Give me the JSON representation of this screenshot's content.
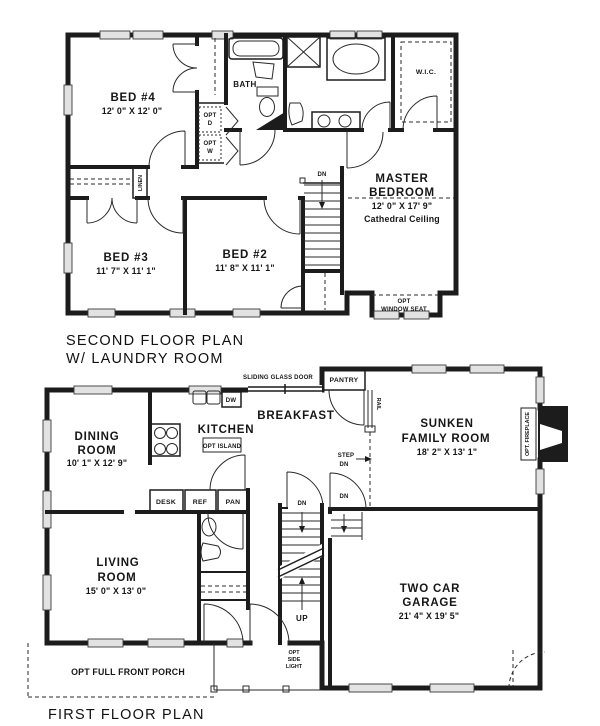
{
  "page": {
    "background": "#ffffff",
    "ink": "#1c1c1c"
  },
  "second_floor": {
    "plan_title_line1": "SECOND FLOOR PLAN",
    "plan_title_line2": "W/ LAUNDRY ROOM",
    "rooms": {
      "bed4": {
        "name": "BED #4",
        "dims": "12' 0\" X 12' 0\""
      },
      "bath": {
        "name": "BATH"
      },
      "wic": {
        "name": "W.I.C."
      },
      "master_bedroom": {
        "name_line1": "MASTER",
        "name_line2": "BEDROOM",
        "dims": "12' 0\" X 17' 9\"",
        "ceiling_note": "Cathedral Ceiling"
      },
      "bed3": {
        "name": "BED #3",
        "dims": "11' 7\" X 11' 1\""
      },
      "bed2": {
        "name": "BED #2",
        "dims": "11' 8\" X 11' 1\""
      }
    },
    "labels": {
      "linen": "LINEN",
      "opt_dryer_line1": "OPT",
      "opt_dryer_line2": "D",
      "opt_washer_line1": "OPT",
      "opt_washer_line2": "W",
      "stairs_down": "DN",
      "window_seat_line1": "OPT",
      "window_seat_line2": "WINDOW SEAT"
    }
  },
  "first_floor": {
    "plan_title": "FIRST FLOOR PLAN",
    "rooms": {
      "dining": {
        "name_line1": "DINING",
        "name_line2": "ROOM",
        "dims": "10' 1\" X 12' 9\""
      },
      "kitchen": {
        "name": "KITCHEN",
        "island": "OPT ISLAND"
      },
      "breakfast": {
        "name": "BREAKFAST"
      },
      "family": {
        "name_line1": "SUNKEN",
        "name_line2": "FAMILY ROOM",
        "dims": "18' 2\" X 13' 1\""
      },
      "living": {
        "name_line1": "LIVING",
        "name_line2": "ROOM",
        "dims": "15' 0\" X 13' 0\""
      },
      "garage": {
        "name_line1": "TWO CAR",
        "name_line2": "GARAGE",
        "dims": "21' 4\" X 19' 5\""
      }
    },
    "labels": {
      "sliding_glass_door": "SLIDING GLASS DOOR",
      "pantry": "PANTRY",
      "dishwasher": "DW",
      "desk": "DESK",
      "refrigerator": "REF",
      "pantry_cabinet": "PAN",
      "rail": "RAIL",
      "step_down_line1": "STEP",
      "step_down_line2": "DN",
      "stairs_down_basement": "DN",
      "stairs_down_garage": "DN",
      "stairs_up": "UP",
      "opt_fireplace": "OPT. FIREPLACE",
      "opt_side_light_line1": "OPT",
      "opt_side_light_line2": "SIDE",
      "opt_side_light_line3": "LIGHT",
      "opt_porch": "OPT FULL FRONT PORCH"
    }
  }
}
